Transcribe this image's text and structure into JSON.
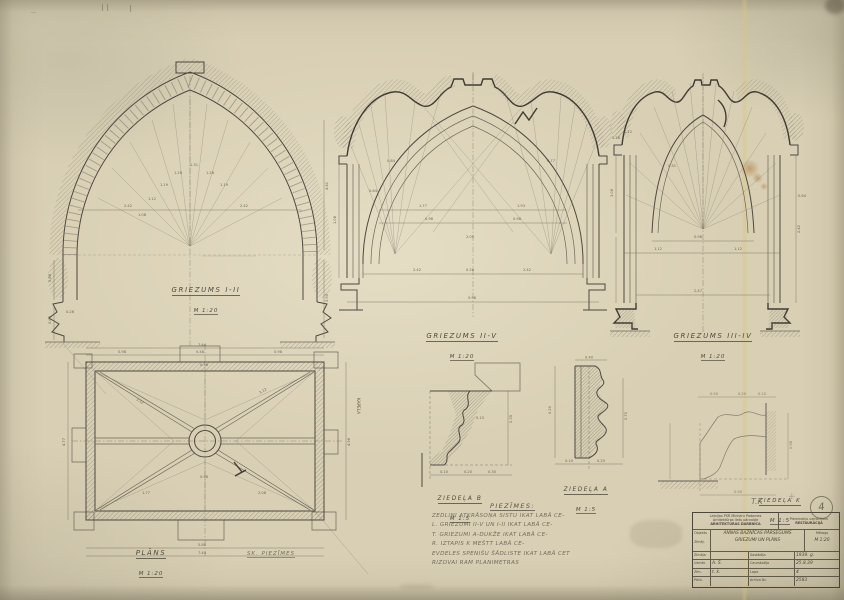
{
  "colors": {
    "paper": "#d8cfb4",
    "ink": "#4b453c",
    "pencil": "#6e675a",
    "stain": "#a86f2e"
  },
  "drawings": {
    "sectionA": {
      "title": "GRIEZUMS I-II",
      "scale": "M 1:20",
      "dims": [
        "1.08",
        "1.12",
        "1.19",
        "1.26",
        "1.31",
        "1.26",
        "1.19",
        "2.42",
        "2.42",
        "0.88",
        "4.41",
        "0.64",
        "0.26",
        "3.95"
      ]
    },
    "sectionB": {
      "title": "GRIEZUMS II-V",
      "scale": "M 1:20",
      "dims": [
        "1.77",
        "1.93",
        "0.98",
        "0.98",
        "2.42",
        "2.42",
        "5.98",
        "0.26",
        "1.08",
        "0.84",
        "0.77",
        "0.64",
        "2.05"
      ]
    },
    "sectionC": {
      "title": "GRIEZUMS III-IV",
      "scale": "M 1:20",
      "dims": [
        "0.98",
        "1.12",
        "1.12",
        "2.47",
        "3.08",
        "2.42",
        "0.26",
        "0.12",
        "0.64",
        "0.31"
      ]
    },
    "plan": {
      "title": "PLĀNS",
      "scale": "M 1:20",
      "note": "SK. PIEZĪMES",
      "vertical_note": "KAPELA",
      "dims": [
        "0.98",
        "5.48",
        "0.98",
        "7.44",
        "5.80",
        "7.44",
        "4.77",
        "4.98",
        "3.12",
        "3.12",
        "1.77",
        "0.98",
        "2.08",
        "0.56"
      ]
    },
    "detailB": {
      "title": "ZIEDEĻA B",
      "scale": "M 1:5",
      "dims": [
        "0.35",
        "0.20",
        "0.10",
        "0.30",
        "0.15"
      ]
    },
    "detailA": {
      "title": "ZIEDEĻA A",
      "scale": "M 1:5",
      "dims": [
        "0.40",
        "0.10",
        "0.25",
        "0.70",
        "0.20"
      ]
    },
    "detailK": {
      "title": "ZIEDEĻA K",
      "scale": "M 1:5",
      "dims": [
        "0.50",
        "0.20",
        "0.10",
        "0.98",
        "0.90"
      ]
    }
  },
  "notes": {
    "title": "PIEZĪMES:",
    "lines": [
      "ZEDLIŅI ATKRĀSOŅA SISTU IKAT LABĀ CE-",
      "L. GRIEZUMI II-V UN I-II IKAT LABĀ CE-",
      "T. GRIEZUMI A-DUKŽE IKAT LABĀ CE-",
      "R. IZTAPIS K MEŠTT LABĀ CE-",
      "EVDELES SPENIŠU ŠĀDLISTE IKAT LABĀ CET",
      "RIZOVAI RAM PLANIMETRAS"
    ]
  },
  "title_block": {
    "agency_line1": "Latvijas PSR Ministru Padomes",
    "agency_line2": "Arhitektūras lietu pārvalde",
    "agency_line3": "ARHITEKTŪRAS DARBNĪCA",
    "dept_line1": "Pieminekļu uzmērījumi",
    "dept_line2": "RESTAURĀCIJA",
    "object_label": "Objekts",
    "object_value": "ANNAS BAZNĪCAS PĀRSEGUMS",
    "content_label": "Zīmēj.",
    "content_value": "GRIEZUMI UN PLĀNS",
    "scale_label": "Mērogs",
    "scale_value": "M 1:20",
    "rows": [
      [
        "Zīmēja",
        "",
        "Sastādīja",
        "1939. g."
      ],
      [
        "Uzmēr.",
        "A. Š.",
        "Caurskatīja",
        "25.8.39"
      ],
      [
        "Zīm.",
        "t. k.",
        "Lapa",
        "4"
      ],
      [
        "Pārb.",
        "",
        "Arhīva Nr.",
        "2583"
      ]
    ]
  },
  "marks": {
    "tk": "T.K",
    "plate_number": "4",
    "corner_scribble": "~"
  }
}
